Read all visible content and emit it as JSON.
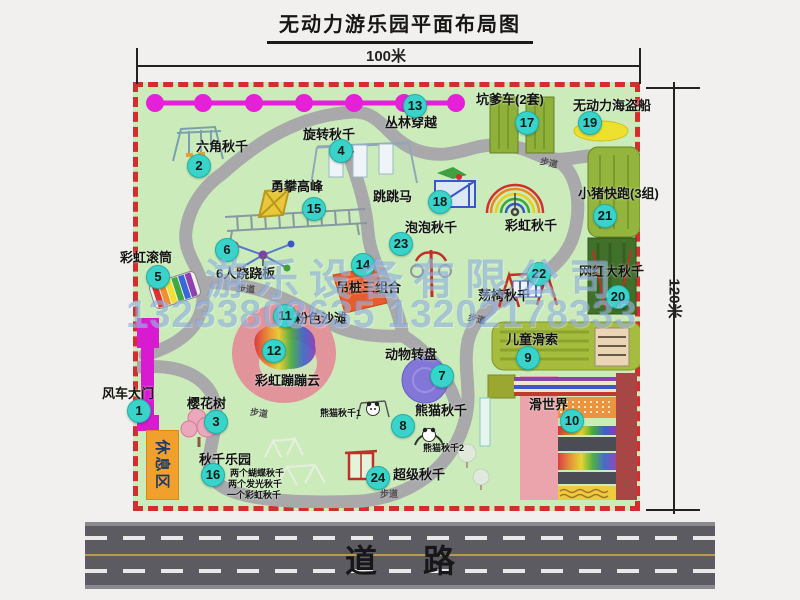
{
  "title": "无动力游乐园平面布局图",
  "dim": {
    "w": "100米",
    "h": "120米"
  },
  "road": {
    "label": "道路"
  },
  "watermark": {
    "company": "游乐设备有限公司",
    "phone": "13233803635 13202178333"
  },
  "path_label": "步道",
  "rest_area": "休息区",
  "labels": {
    "rainbow_swing": "彩虹秋千",
    "panda1": "熊猫秋千1",
    "panda2": "熊猫秋千2"
  },
  "swing_notes": [
    "两个蝴蝶秋千",
    "两个发光秋千",
    "一个彩虹秋千"
  ],
  "items": [
    {
      "num": "1",
      "label": "风车大门"
    },
    {
      "num": "2",
      "label": "六角秋千"
    },
    {
      "num": "3",
      "label": "樱花树"
    },
    {
      "num": "4",
      "label": "旋转秋千"
    },
    {
      "num": "5",
      "label": "彩虹滚筒"
    },
    {
      "num": "6",
      "label": "6人跷跷板"
    },
    {
      "num": "7",
      "label": "动物转盘"
    },
    {
      "num": "8",
      "label": "熊猫秋千"
    },
    {
      "num": "9",
      "label": "儿童滑索"
    },
    {
      "num": "10",
      "label": "滑世界"
    },
    {
      "num": "11",
      "label": "粉色沙滩"
    },
    {
      "num": "12",
      "label": "彩虹蹦蹦云"
    },
    {
      "num": "13",
      "label": "丛林穿越"
    },
    {
      "num": "14",
      "label": "吊桩三组合"
    },
    {
      "num": "15",
      "label": "勇攀高峰"
    },
    {
      "num": "16",
      "label": "秋千乐园"
    },
    {
      "num": "17",
      "label": "坑爹车(2套)"
    },
    {
      "num": "18",
      "label": "跳跳马"
    },
    {
      "num": "19",
      "label": "无动力海盗船"
    },
    {
      "num": "20",
      "label": "网红大秋千"
    },
    {
      "num": "21",
      "label": "小猪快跑(3组)"
    },
    {
      "num": "22",
      "label": "荡椅秋千"
    },
    {
      "num": "23",
      "label": "泡泡秋千"
    },
    {
      "num": "24",
      "label": "超级秋千"
    }
  ]
}
